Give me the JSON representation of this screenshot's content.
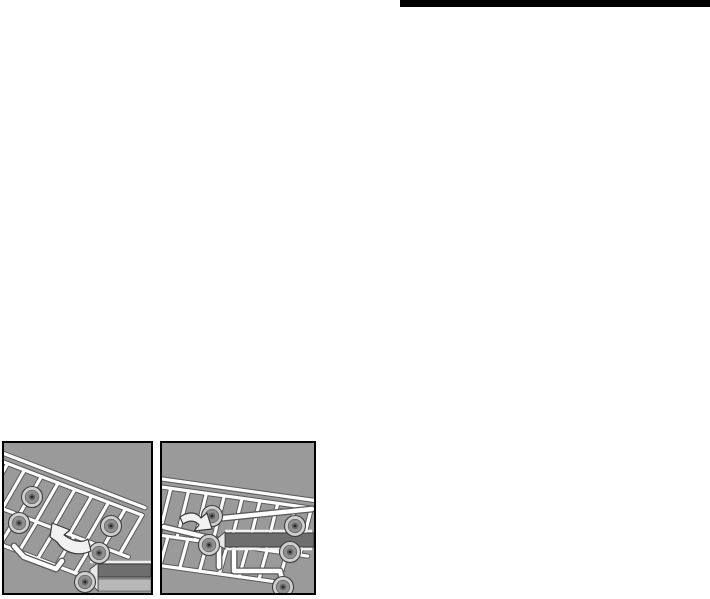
{
  "page": {
    "background_color": "#ffffff"
  },
  "top_rule": {
    "color": "#000000"
  },
  "figures": {
    "colors": {
      "panel_background": "#9a9a9a",
      "panel_border": "#000000",
      "wire": "#ffffff",
      "wire_outline": "#5a5a5a",
      "wheel_rim": "#cfcfcf",
      "wheel_tire": "#8f8f8f",
      "wheel_hub": "#262626",
      "rail_dark": "#6e6e6e",
      "rail_light": "#b8b8b8",
      "rail_highlight": "#f0f0f0",
      "arrow_fill": "#f2f2f2",
      "arrow_outline": "#3a3a3a"
    },
    "left": {
      "name": "rack-tilted-with-rotation-arrow"
    },
    "right": {
      "name": "rack-level-with-slide-arrow"
    }
  }
}
